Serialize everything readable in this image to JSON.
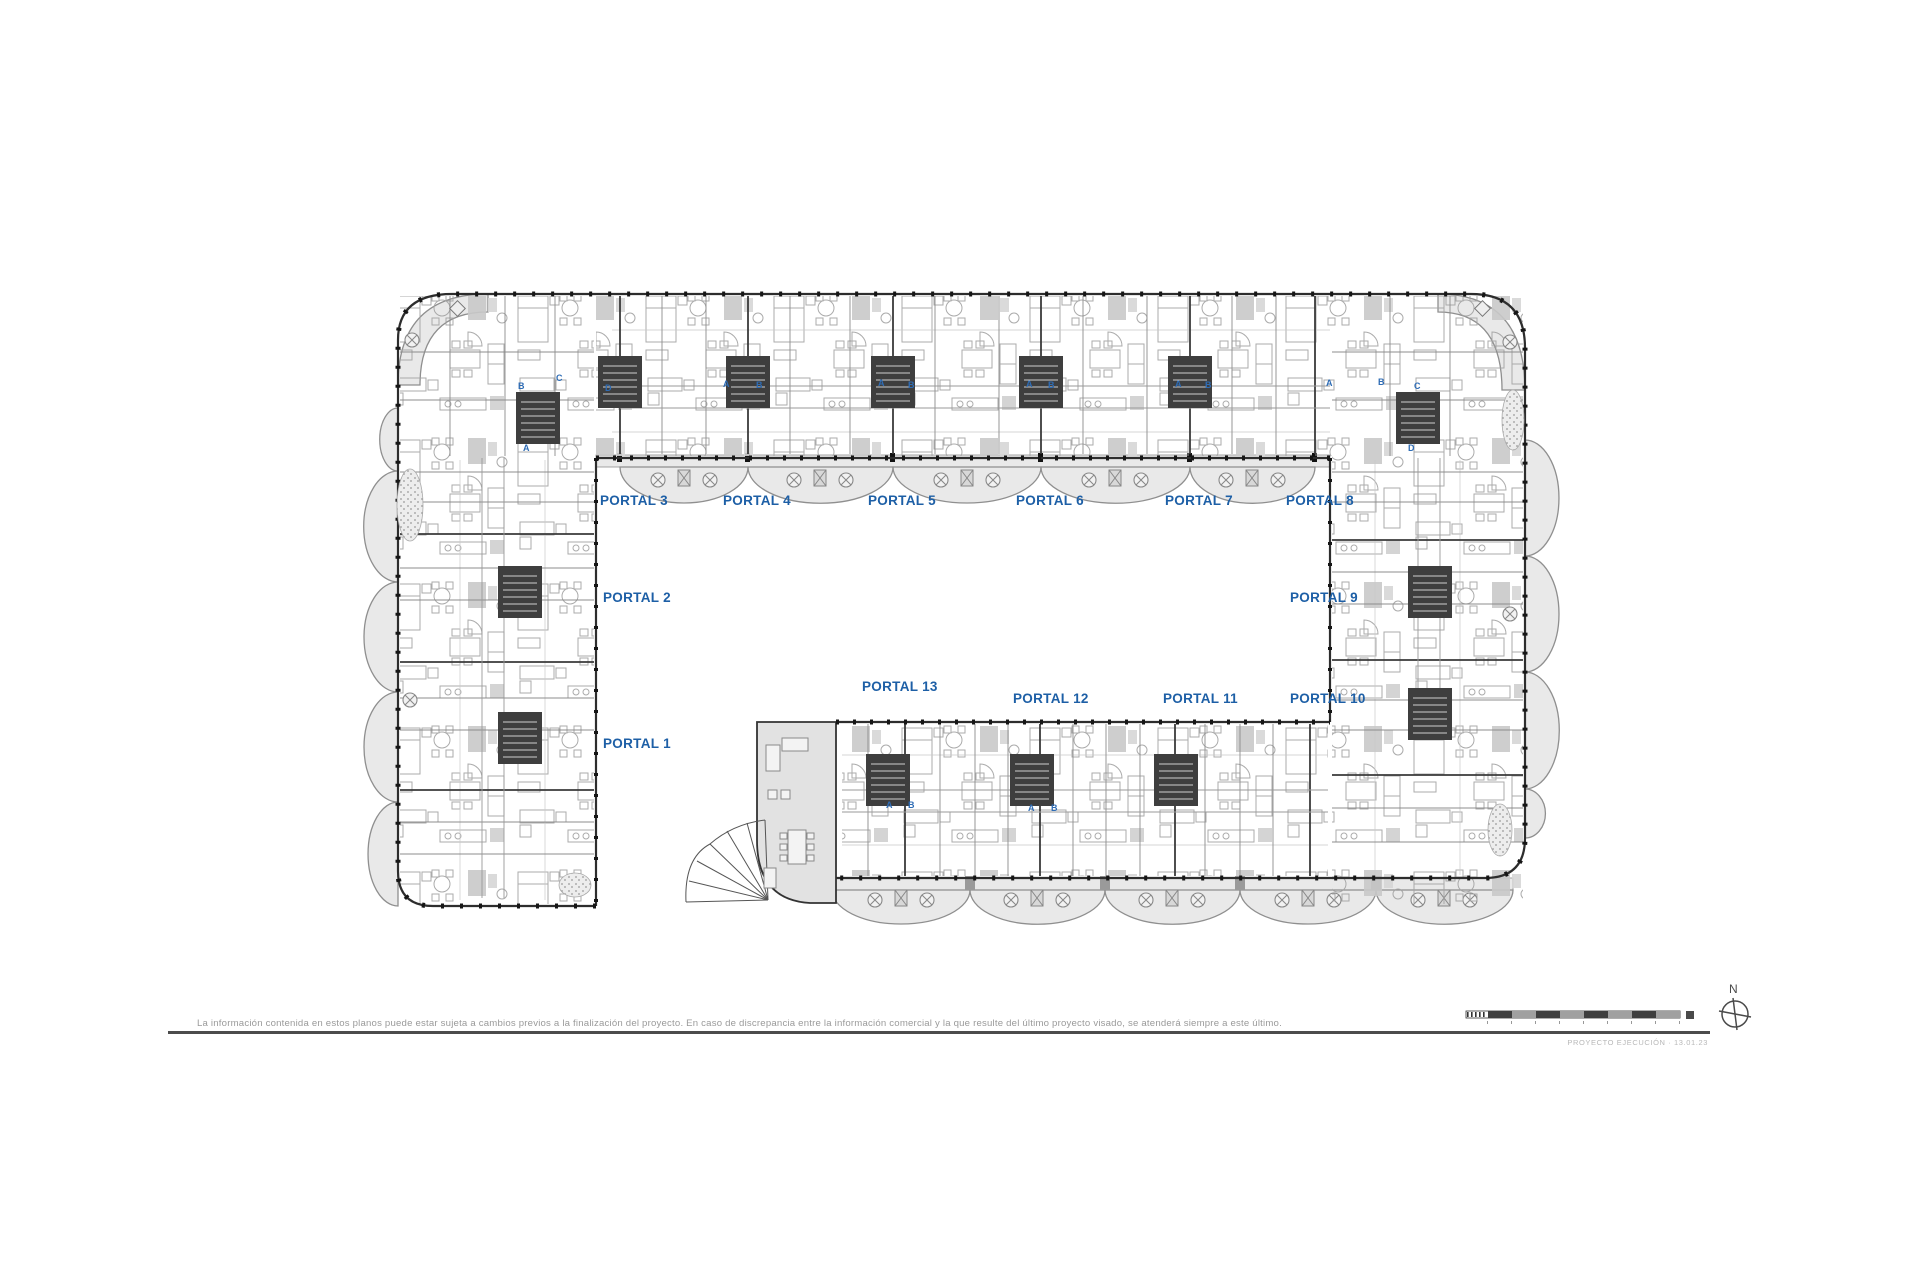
{
  "plan": {
    "portals": [
      {
        "label": "PORTAL 1"
      },
      {
        "label": "PORTAL 2"
      },
      {
        "label": "PORTAL 3"
      },
      {
        "label": "PORTAL 4"
      },
      {
        "label": "PORTAL 5"
      },
      {
        "label": "PORTAL 6"
      },
      {
        "label": "PORTAL 7"
      },
      {
        "label": "PORTAL 8"
      },
      {
        "label": "PORTAL 9"
      },
      {
        "label": "PORTAL 10"
      },
      {
        "label": "PORTAL 11"
      },
      {
        "label": "PORTAL 12"
      },
      {
        "label": "PORTAL 13"
      }
    ],
    "unit_markers": [
      {
        "label": "B"
      },
      {
        "label": "C"
      },
      {
        "label": "A"
      },
      {
        "label": "D"
      },
      {
        "label": "A"
      },
      {
        "label": "B"
      },
      {
        "label": "A"
      },
      {
        "label": "B"
      },
      {
        "label": "A"
      },
      {
        "label": "B"
      },
      {
        "label": "A"
      },
      {
        "label": "B"
      },
      {
        "label": "A"
      },
      {
        "label": "B"
      },
      {
        "label": "C"
      },
      {
        "label": "D"
      },
      {
        "label": "A"
      },
      {
        "label": "B"
      },
      {
        "label": "A"
      },
      {
        "label": "B"
      }
    ]
  },
  "footer": {
    "disclaimer": "La información contenida en estos planos puede estar sujeta a cambios previos a la finalización del proyecto. En caso de discrepancia entre la información comercial y la que resulte del último proyecto visado, se atenderá siempre a este último.",
    "project_text": "PROYECTO EJECUCIÓN · 13.01.23",
    "north_label": "N"
  },
  "colors": {
    "portal_label": "#1d5fa6",
    "unit_letter": "#2e6cb5",
    "wall_line": "#2d2d2d",
    "balcony_fill": "#e9e9e9"
  }
}
